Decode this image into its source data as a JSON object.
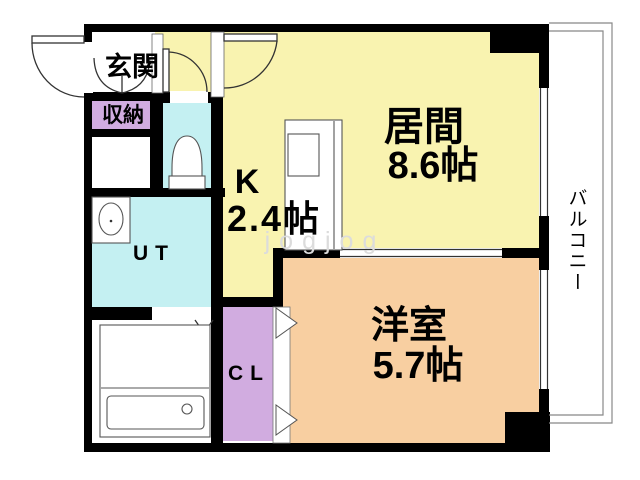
{
  "colors": {
    "wall": "#000000",
    "living_kitchen": "#f9f3b0",
    "water_rooms": "#c4f0f2",
    "closets": "#d1ace0",
    "bedroom": "#f8cfa1"
  },
  "rooms": {
    "genkan": {
      "label": "玄関"
    },
    "shuno": {
      "label": "収納"
    },
    "kitchen": {
      "label": "K",
      "size": "2.4帖"
    },
    "living": {
      "label": "居間",
      "size": "8.6帖"
    },
    "ut": {
      "label": "UT"
    },
    "cl": {
      "label": "CL"
    },
    "bedroom": {
      "label": "洋室",
      "size": "5.7帖"
    },
    "balcony": {
      "label": "バルコニー"
    }
  },
  "watermark": "jogjog"
}
